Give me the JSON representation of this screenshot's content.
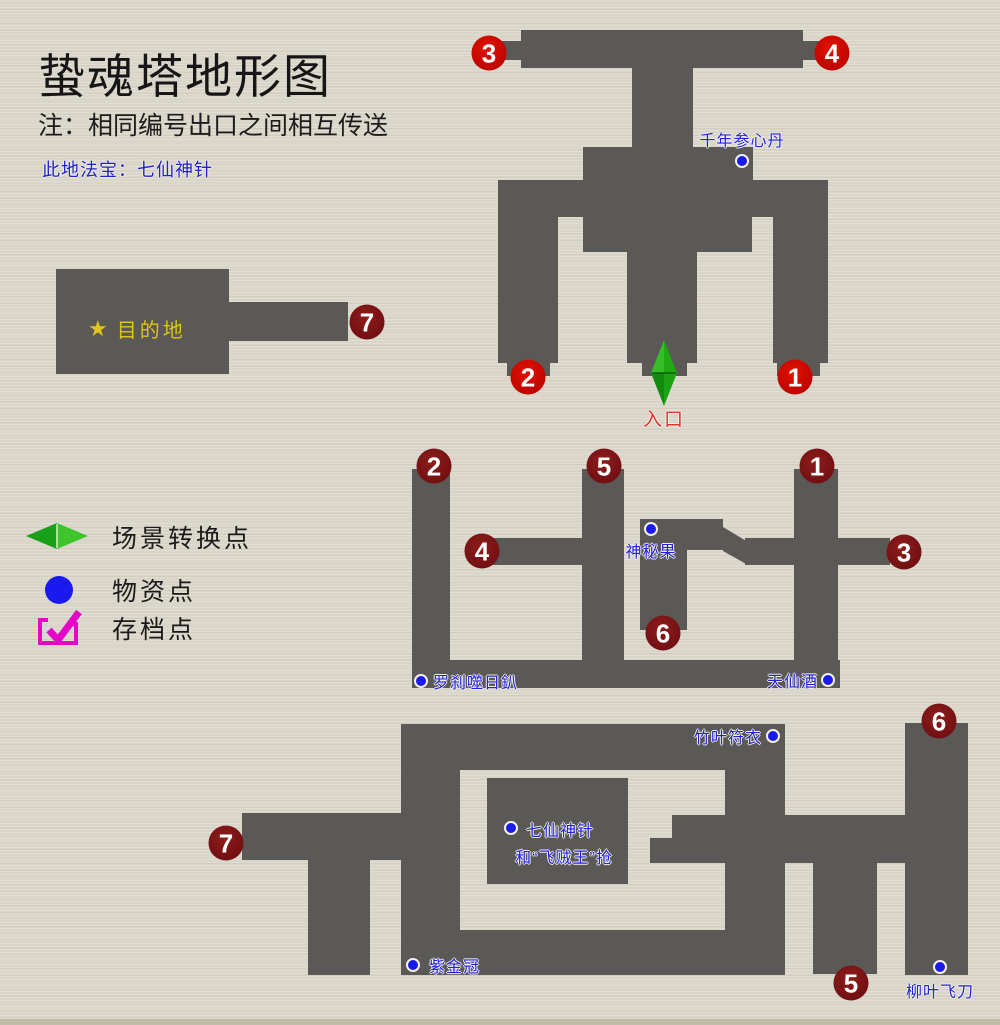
{
  "header": {
    "title": "蛰魂塔地形图",
    "note": "注：相同编号出口之间相互传送",
    "treasure_note": "此地法宝：七仙神针"
  },
  "legend": {
    "items": [
      {
        "icon": "scene-transition-icon",
        "label": "场景转换点"
      },
      {
        "icon": "supply-point-icon",
        "label": "物资点"
      },
      {
        "icon": "save-point-icon",
        "label": "存档点"
      }
    ]
  },
  "entrance": {
    "label": "入口"
  },
  "destination": {
    "star": "★",
    "label": "目的地"
  },
  "portals": [
    {
      "n": "3",
      "tone": "bright"
    },
    {
      "n": "4",
      "tone": "bright"
    },
    {
      "n": "2",
      "tone": "bright"
    },
    {
      "n": "1",
      "tone": "bright"
    },
    {
      "n": "2",
      "tone": "dark"
    },
    {
      "n": "5",
      "tone": "dark"
    },
    {
      "n": "1",
      "tone": "dark"
    },
    {
      "n": "4",
      "tone": "dark"
    },
    {
      "n": "3",
      "tone": "dark"
    },
    {
      "n": "6",
      "tone": "dark"
    },
    {
      "n": "7",
      "tone": "dark"
    },
    {
      "n": "6",
      "tone": "dark"
    },
    {
      "n": "5",
      "tone": "dark"
    },
    {
      "n": "7",
      "tone": "dark"
    }
  ],
  "items": [
    {
      "label": "千年参心丹"
    },
    {
      "label": "神秘果"
    },
    {
      "label": "罗刹噬日釟"
    },
    {
      "label": "天仙酒"
    },
    {
      "label": "竹叶符衣"
    },
    {
      "label": "七仙神针",
      "note": "和“飞贼王”抢"
    },
    {
      "label": "紫金冠"
    },
    {
      "label": "柳叶飞刀"
    }
  ],
  "colors": {
    "background": "#d9d5c8",
    "corridor": "#5a5956",
    "portal_bright": "#c00500",
    "portal_dark": "#731013",
    "item_dot_blue": "#1a1aef",
    "item_label_blue": "#2222dd",
    "entrance_red": "#e03232",
    "destination_yellow": "#ddc41c",
    "scene_green": "#1fa51f",
    "save_magenta": "#e606c8"
  }
}
